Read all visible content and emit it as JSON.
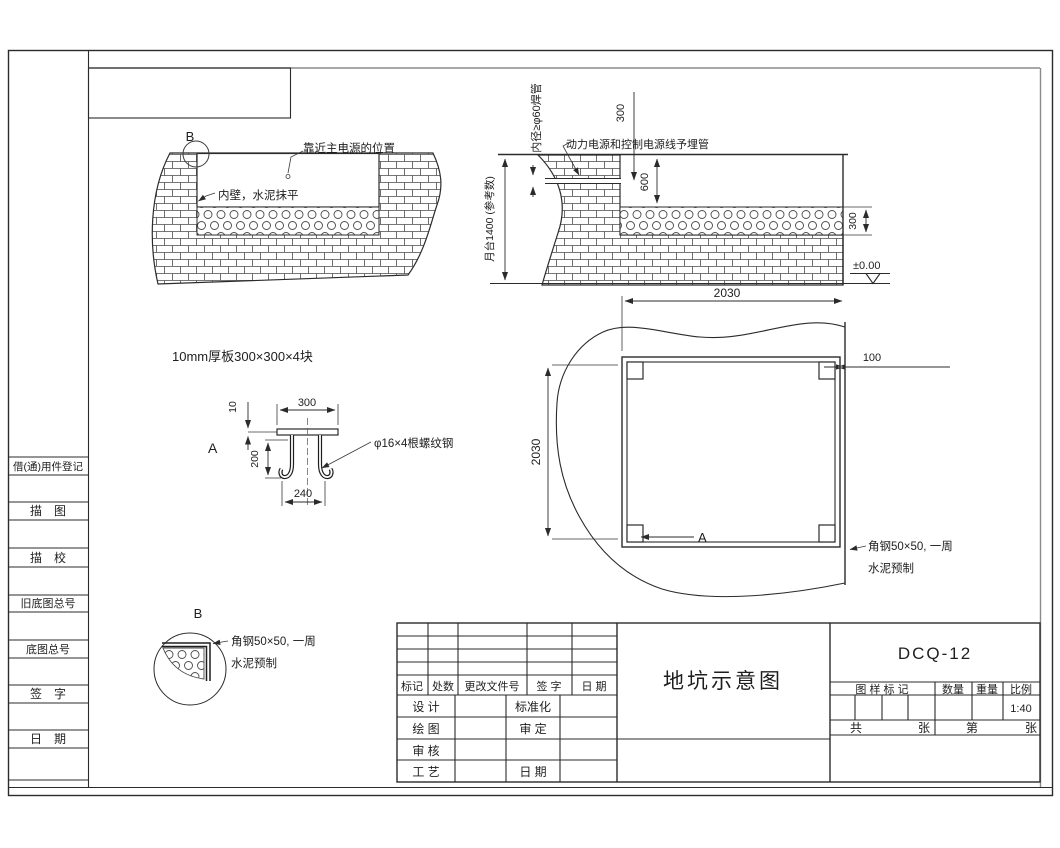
{
  "frame": {
    "sidebar_labels": [
      "借(通)用件登记",
      "描　图",
      "描　校",
      "旧底图总号",
      "底图总号",
      "签　字",
      "日　期"
    ]
  },
  "section_pit_left": {
    "label_b": "B",
    "note_power": "靠近主电源的位置",
    "note_wall": "内壁，水泥抹平"
  },
  "section_pit_right": {
    "note_pipe_vert": "内径≥φ60焊管",
    "note_conduit": "动力电源和控制电源线予埋管",
    "dim_300_top": "300",
    "dim_600": "600",
    "dim_platform": "月台1400 (参考数)",
    "dim_300_right": "300",
    "level_value": "±0.00"
  },
  "detail_a": {
    "caption": "10mm厚板300×300×4块",
    "dim_10": "10",
    "dim_300": "300",
    "dim_200": "200",
    "dim_240": "240",
    "label_a": "A",
    "note_rebar": "φ16×4根螺纹钢"
  },
  "plan": {
    "dim_width": "2030",
    "dim_height": "2030",
    "dim_100": "100",
    "label_a": "A",
    "note_angle": "角钢50×50, 一周",
    "note_concrete": "水泥预制"
  },
  "detail_b": {
    "label_b": "B",
    "note_angle": "角钢50×50, 一周",
    "note_concrete": "水泥预制"
  },
  "title_block": {
    "title": "地坑示意图",
    "drawing_no": "DCQ-12",
    "change_header": [
      "标记",
      "处数",
      "更改文件号",
      "签  字",
      "日  期"
    ],
    "row_design": "设  计",
    "row_std": "标准化",
    "row_draw": "绘  图",
    "row_approve": "审  定",
    "row_check": "审  核",
    "row_process": "工  艺",
    "row_date": "日  期",
    "mark_header": "图 样 标 记",
    "qty_label": "数量",
    "weight_label": "重量",
    "scale_label": "比例",
    "scale_value": "1:40",
    "sheet_total_label": "共",
    "sheet_unit1": "张",
    "sheet_no_label": "第",
    "sheet_unit2": "张"
  }
}
